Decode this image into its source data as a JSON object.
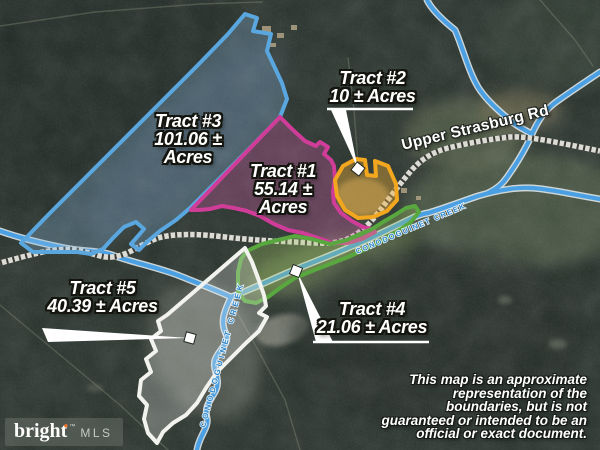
{
  "map": {
    "road_label": "Upper Strasburg Rd",
    "creek_label": "CONODOGUINET CREEK",
    "disclaimer_lines": [
      "This map is an approximate",
      "representation of the",
      "boundaries, but is not",
      "guaranteed or intended to be an",
      "official or exact document."
    ],
    "colors": {
      "creek": "#4aa0e2",
      "creek_casing": "#e6eef2",
      "road_base": "#dcdcd4",
      "road_ties": "#1d1d1b",
      "leader": "#ffffff"
    }
  },
  "tracts": [
    {
      "label": "Tract #1",
      "acres": [
        "55.14 ±",
        "Acres"
      ],
      "color": "#cf3d98",
      "fill_rgba": "rgba(210,90,170,0.33)"
    },
    {
      "label": "Tract #2",
      "acres": [
        "10 ± Acres"
      ],
      "color": "#f3a71f",
      "fill_rgba": "rgba(235,170,50,0.40)"
    },
    {
      "label": "Tract #3",
      "acres": [
        "101.06 ±",
        "Acres"
      ],
      "color": "#5aa7e0",
      "fill_rgba": "rgba(140,185,225,0.30)"
    },
    {
      "label": "Tract #4",
      "acres": [
        "21.06 ± Acres"
      ],
      "color": "#58a83f",
      "fill_rgba": "rgba(160,200,95,0.30)"
    },
    {
      "label": "Tract #5",
      "acres": [
        "40.39 ± Acres"
      ],
      "color": "#f2f2ee",
      "fill_rgba": "rgba(235,235,230,0.28)"
    }
  ],
  "logo": {
    "brand": "bright",
    "spark": "●",
    "tm": "™",
    "suffix": "MLS"
  }
}
